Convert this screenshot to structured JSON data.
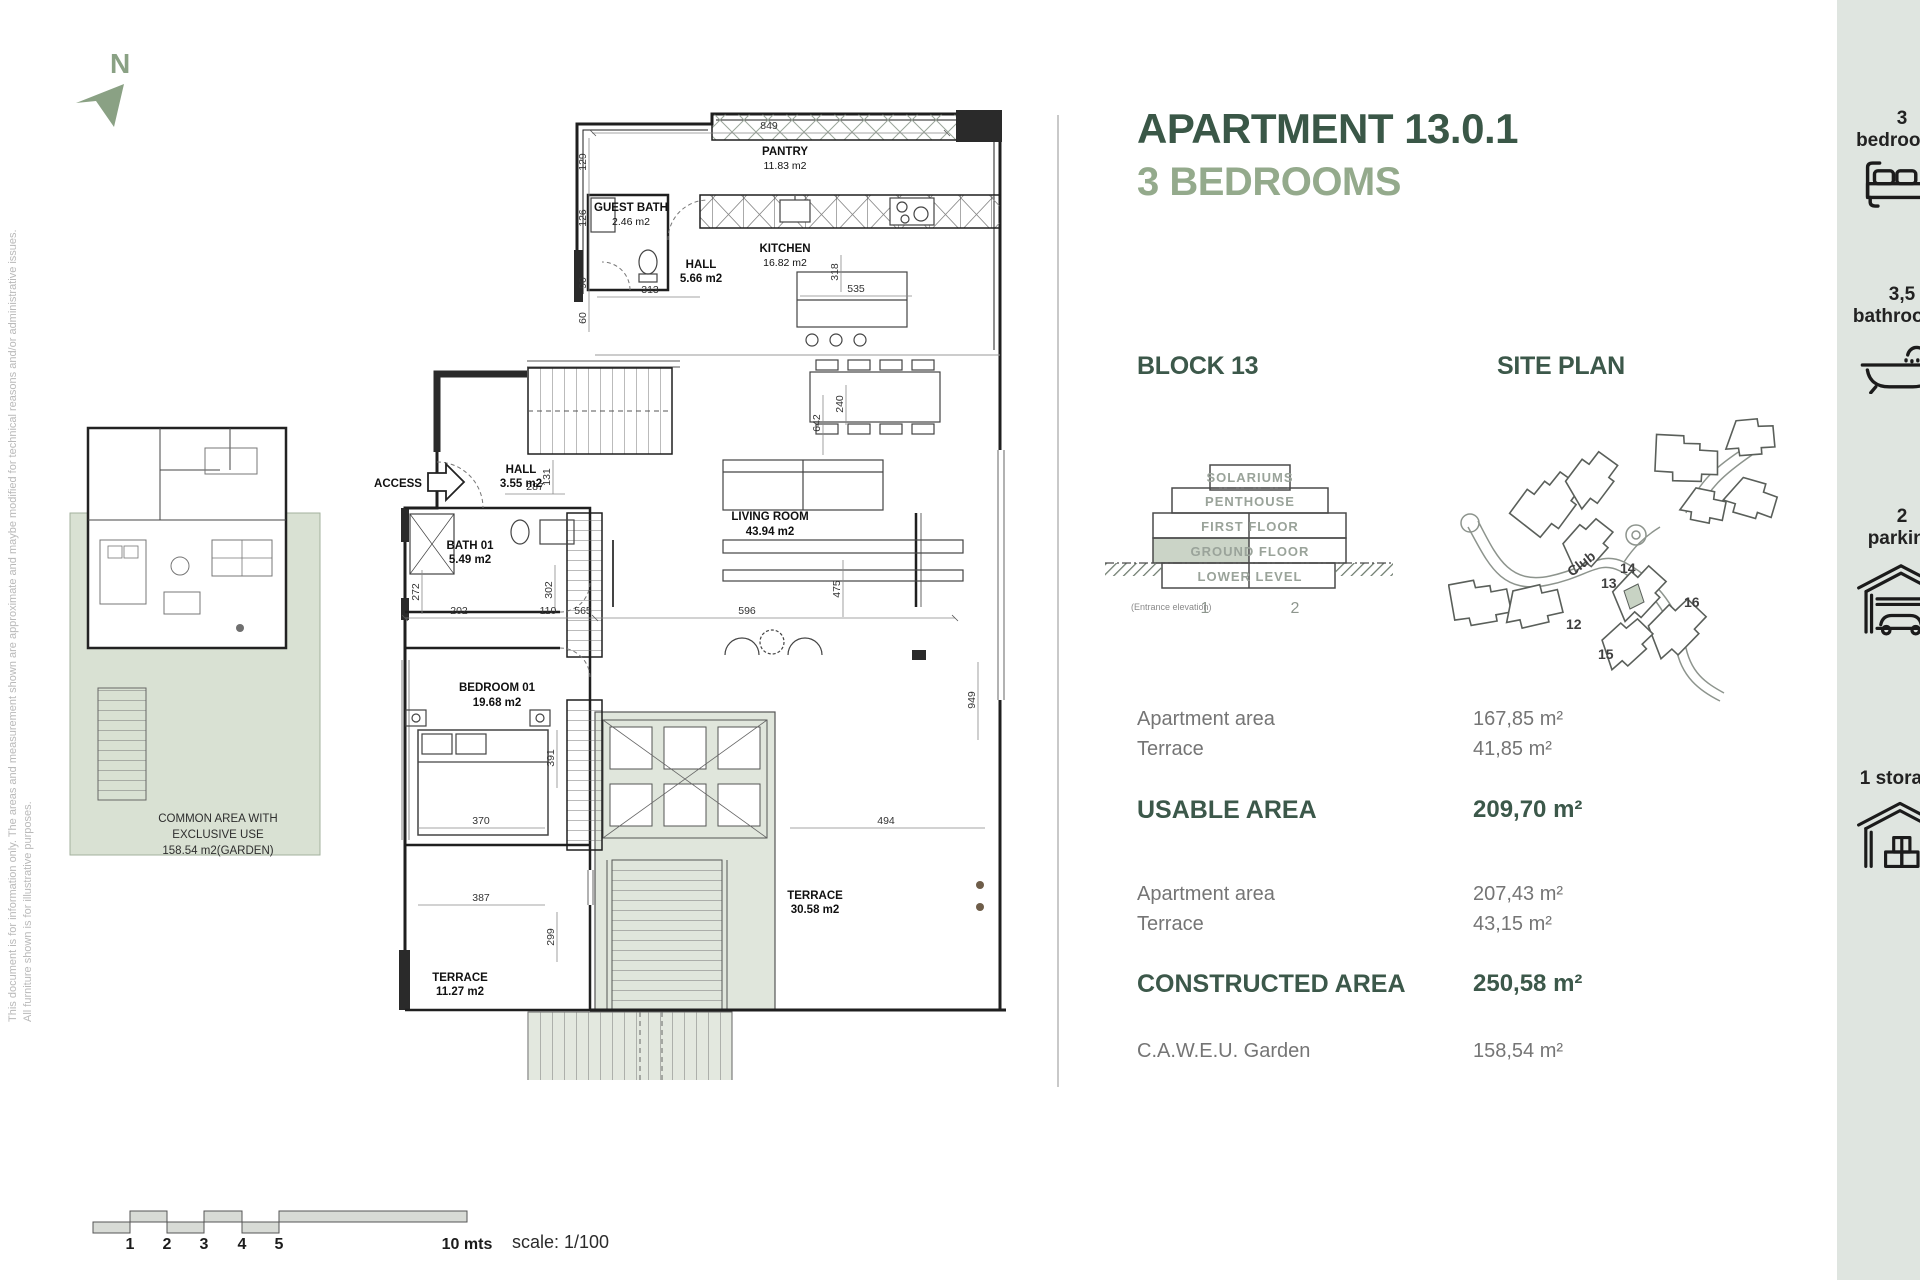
{
  "disclaimer": {
    "line1": "This document is for information only. The areas and measurement shown are approximate and maybe modified for technical reasons and/or administrative issues.",
    "line2": "All furniture shown is for illustrative purposes."
  },
  "north": {
    "label": "N"
  },
  "header": {
    "title": "APARTMENT 13.0.1",
    "subtitle": "3 BEDROOMS"
  },
  "block": {
    "heading": "BLOCK 13",
    "floors": [
      "SOLARIUMS",
      "PENTHOUSE",
      "FIRST FLOOR",
      "GROUND FLOOR",
      "LOWER LEVEL"
    ],
    "unit_left": "1",
    "unit_right": "2",
    "caption": "(Entrance elevation)"
  },
  "site": {
    "heading": "SITE PLAN",
    "club": "Club",
    "b12": "12",
    "b13": "13",
    "b14": "14",
    "b15": "15",
    "b16": "16"
  },
  "areas": {
    "usable_rows": [
      {
        "label": "Apartment area",
        "value": "167,85 m²"
      },
      {
        "label": "Terrace",
        "value": "41,85 m²"
      }
    ],
    "usable_label": "USABLE AREA",
    "usable_value": "209,70 m²",
    "constructed_rows": [
      {
        "label": "Apartment area",
        "value": "207,43 m²"
      },
      {
        "label": "Terrace",
        "value": "43,15 m²"
      }
    ],
    "constructed_label": "CONSTRUCTED AREA",
    "constructed_value": "250,58 m²",
    "garden_label": "C.A.W.E.U. Garden",
    "garden_value": "158,54 m²"
  },
  "amenities": [
    {
      "line1": "3",
      "line2": "bedrooms"
    },
    {
      "line1": "3,5",
      "line2": "bathrooms"
    },
    {
      "line1": "2",
      "line2": "parking"
    },
    {
      "line1": "1 storage",
      "line2": ""
    }
  ],
  "plan": {
    "access": "ACCESS",
    "rooms": [
      {
        "name": "PANTRY",
        "area": "11.83 m2"
      },
      {
        "name": "GUEST BATH",
        "area": "2.46 m2"
      },
      {
        "name": "KITCHEN",
        "area": "16.82 m2"
      },
      {
        "name": "HALL",
        "area": "5.66 m2"
      },
      {
        "name": "HALL",
        "area": "3.55 m2"
      },
      {
        "name": "BATH 01",
        "area": "5.49 m2"
      },
      {
        "name": "BEDROOM 01",
        "area": "19.68 m2"
      },
      {
        "name": "LIVING ROOM",
        "area": "43.94 m2"
      },
      {
        "name": "TERRACE",
        "area": "30.58 m2"
      },
      {
        "name": "TERRACE",
        "area": "11.27 m2"
      }
    ],
    "dims": [
      "849",
      "129",
      "126",
      "90",
      "60",
      "313",
      "318",
      "535",
      "642",
      "240",
      "287",
      "131",
      "272",
      "202",
      "110",
      "565",
      "302",
      "596",
      "475",
      "391",
      "370",
      "387",
      "299",
      "494",
      "949"
    ],
    "common": [
      "COMMON AREA WITH",
      "EXCLUSIVE USE",
      "158.54 m2(GARDEN)"
    ]
  },
  "scalebar": {
    "t1": "1",
    "t2": "2",
    "t3": "3",
    "t4": "4",
    "t5": "5",
    "end": "10 mts",
    "scale": "scale: 1/100"
  }
}
